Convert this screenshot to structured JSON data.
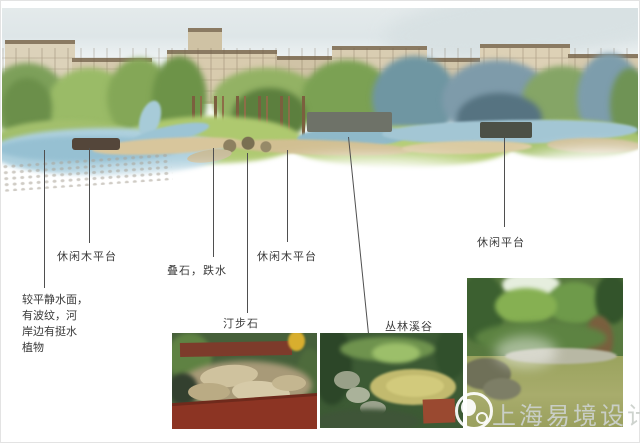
{
  "scene_labels": {
    "platform_left": "休闲木平台",
    "cascade": "叠石，跌水",
    "platform_mid": "休闲木平台",
    "platform_right": "休闲平台"
  },
  "photo_captions": {
    "stepping_stones": "汀步石",
    "forest_valley": "丛林溪谷"
  },
  "note": {
    "line1": "较平静水面，",
    "line2": "有波纹，河",
    "line3": "岸边有挺水",
    "line4": "植物"
  },
  "watermark": {
    "brand": "上海易境设计"
  },
  "colors": {
    "sky": "#e3e9ea",
    "tree_green": "#8fae5f",
    "tree_bluegreen": "#7e9baa",
    "water": "#aed0de",
    "grass": "#aec96f",
    "sand": "#d6c69c",
    "building": "#d8cbae",
    "leader_line": "#4f4f4f",
    "label_text": "#3a3a3a",
    "watermark_gray": "#ccd1cc",
    "photo_red_wall": "#8c3423"
  }
}
